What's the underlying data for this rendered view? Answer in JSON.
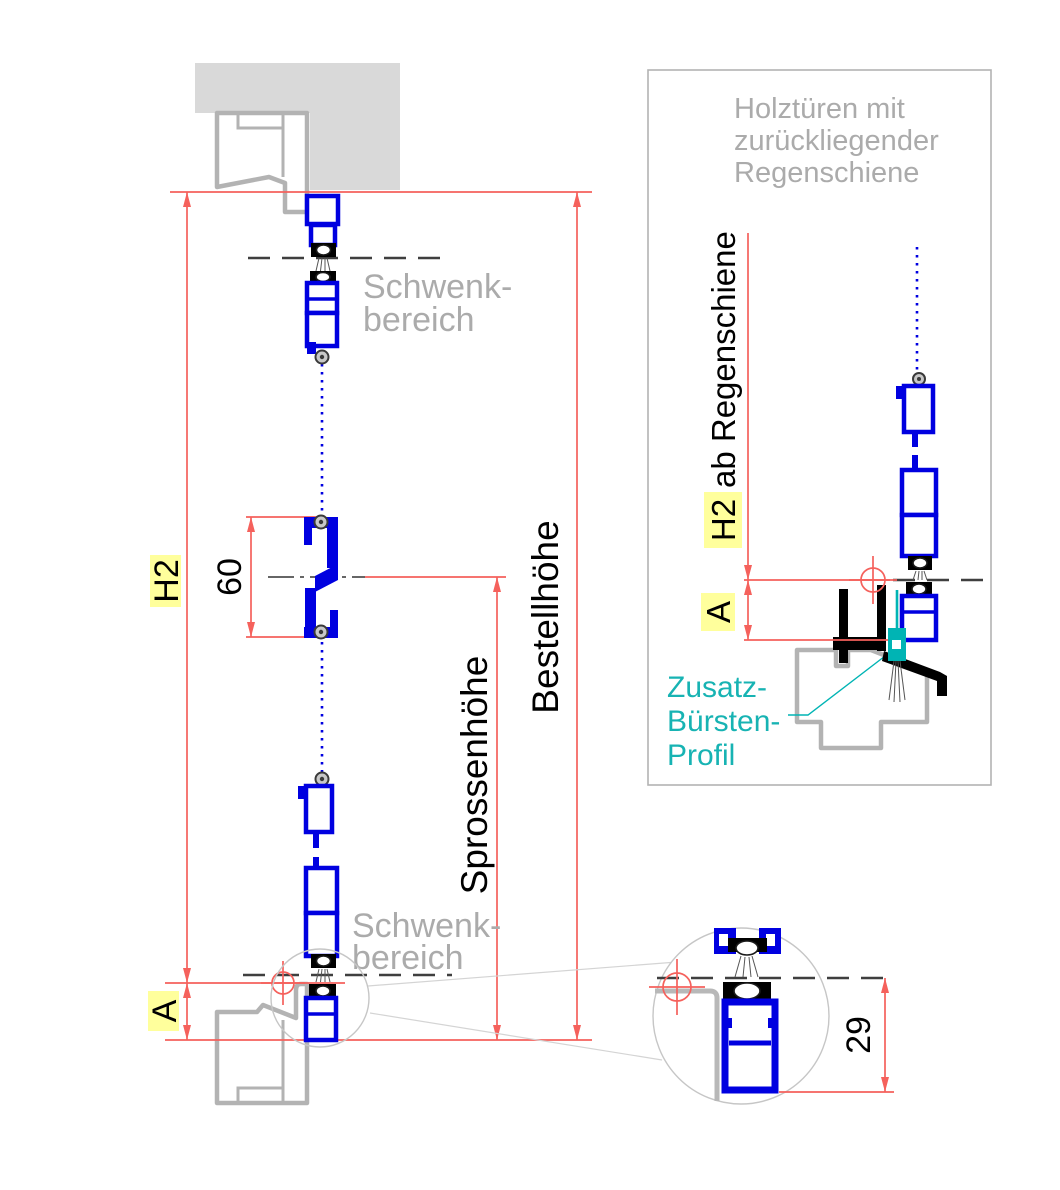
{
  "colors": {
    "profile_blue": "#0000e0",
    "dimension_red": "#f5615c",
    "highlight_yellow": "#ffff9c",
    "brush_teal": "#00b4b4",
    "teal_text": "#17b3b3",
    "outline_gray": "#b3b3b3",
    "text_gray": "#ababab",
    "wall_gray": "#d9d9d9",
    "dash_dark": "#3f3f3f"
  },
  "left_drawing": {
    "dim_h2": "H2",
    "dim_a": "A",
    "dim_60": "60",
    "sprossenhoehe_label": "Sprossenhöhe",
    "bestellhoehe_label": "Bestellhöhe",
    "schwenkbereich_top": {
      "line1": "Schwenk-",
      "line2": "bereich"
    },
    "schwenkbereich_bottom": {
      "line1": "Schwenk-",
      "line2": "bereich"
    }
  },
  "inset": {
    "title_line1": "Holztüren mit",
    "title_line2": "zurückliegender",
    "title_line3": "Regenschiene",
    "dim_h2": "H2",
    "dim_h2_suffix": "ab Regenschiene",
    "dim_a": "A",
    "brush_label_line1": "Zusatz-",
    "brush_label_line2": "Bürsten-",
    "brush_label_line3": "Profil"
  },
  "detail": {
    "dim_29": "29"
  }
}
